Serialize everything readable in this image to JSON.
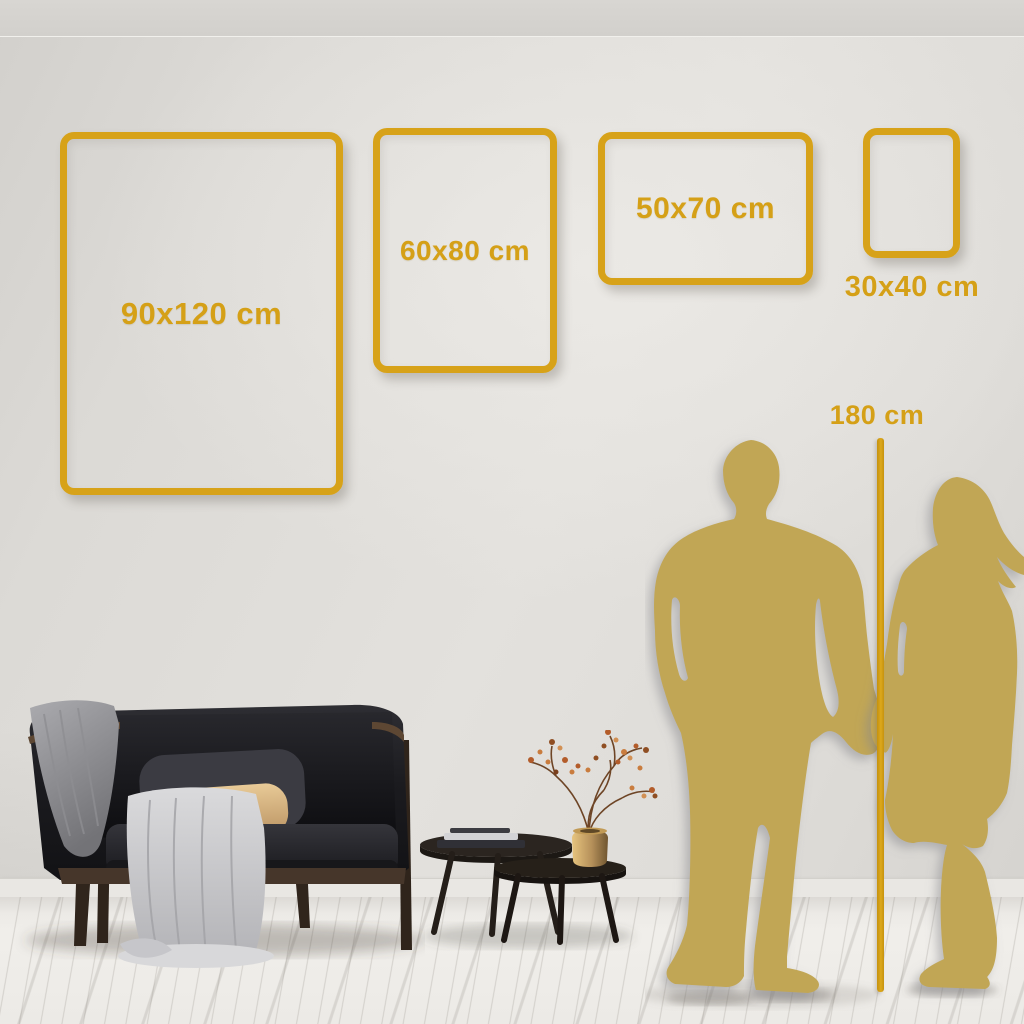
{
  "size_guide": {
    "frames": [
      {
        "label": "90x120 cm"
      },
      {
        "label": "60x80 cm"
      },
      {
        "label": "50x70 cm"
      },
      {
        "label": "30x40 cm"
      }
    ],
    "height_reference_label": "180 cm"
  },
  "colors": {
    "accent_gold": "#D7A219",
    "line_gold": "#D29B10",
    "silhouette_gold": "#C1A654",
    "wall": "#DEDCD8",
    "floor": "#F1EFEB"
  },
  "illustrations": [
    "sofa-illustration",
    "coffee-tables-illustration",
    "man-silhouette",
    "woman-silhouette",
    "height-reference-line"
  ]
}
